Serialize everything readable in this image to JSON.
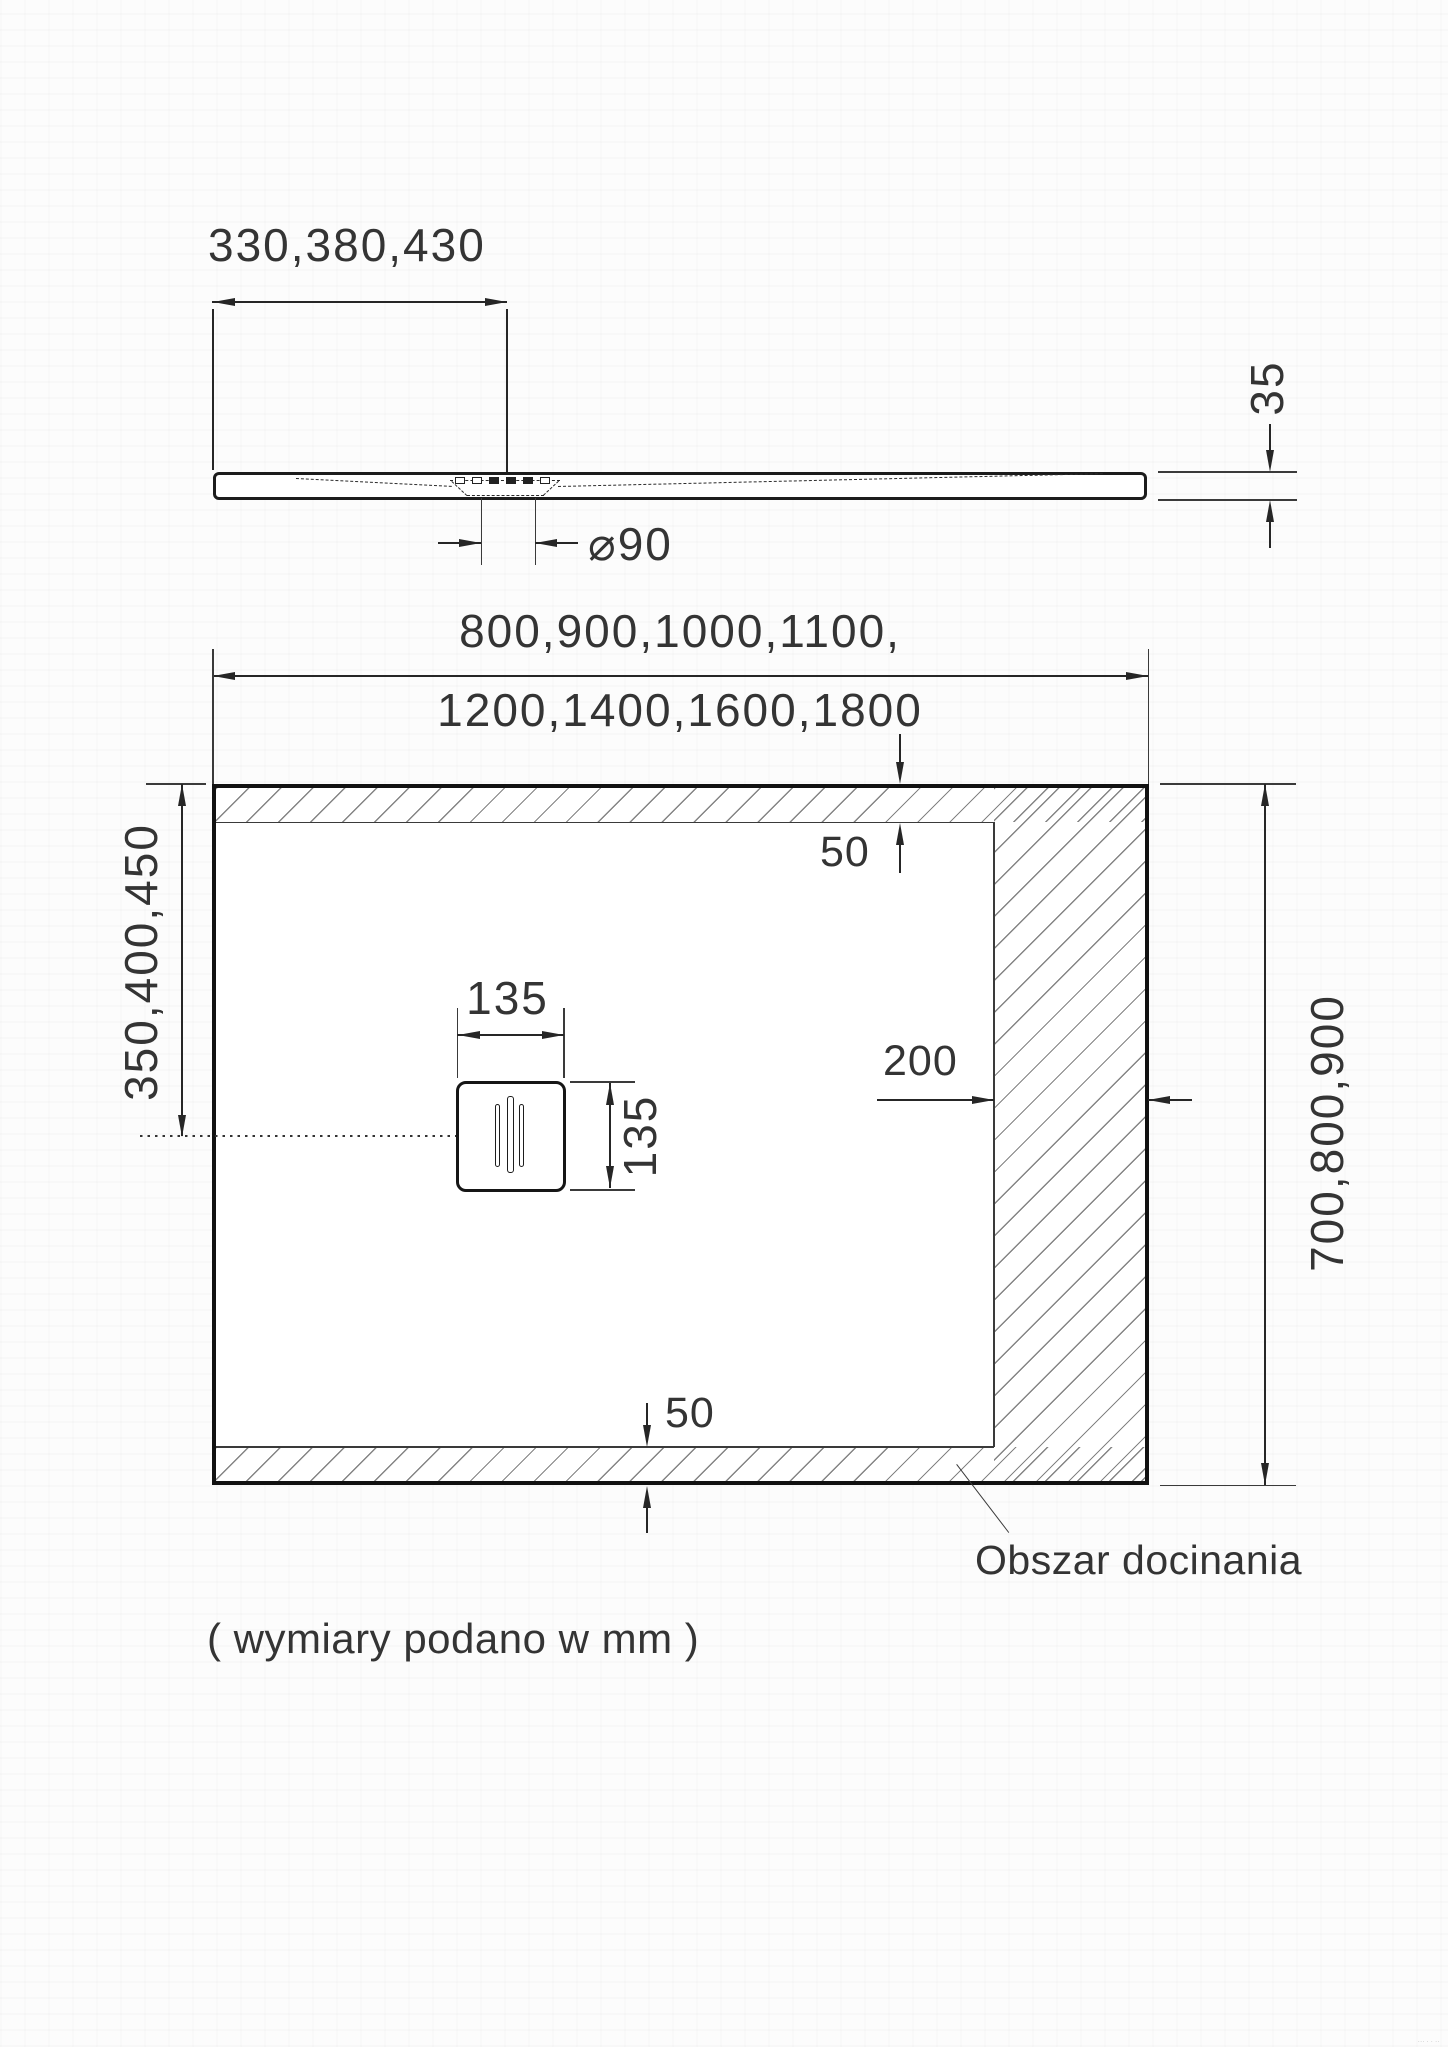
{
  "side_view": {
    "dim_drain_offset": "330,380,430",
    "dim_drain_diameter": "⌀90",
    "dim_thickness": "35"
  },
  "plan_view": {
    "dim_width_line1": "800,900,1000,1100,",
    "dim_width_line2": "1200,1400,1600,1800",
    "dim_left_drain_offset": "350,400,450",
    "dim_height": "700,800,900",
    "dim_drain_width": "135",
    "dim_drain_height": "135",
    "dim_cut_right": "200",
    "dim_cut_top": "50",
    "dim_cut_bottom": "50",
    "cut_area_label": "Obszar docinania"
  },
  "footer": {
    "units_note": "( wymiary podano w mm )",
    "micro_note": "··· · · ·· ···· ··"
  },
  "colors": {
    "line": "#262626",
    "text": "#343434",
    "hatch": "#5a5a5a",
    "background": "#fcfcfc"
  }
}
